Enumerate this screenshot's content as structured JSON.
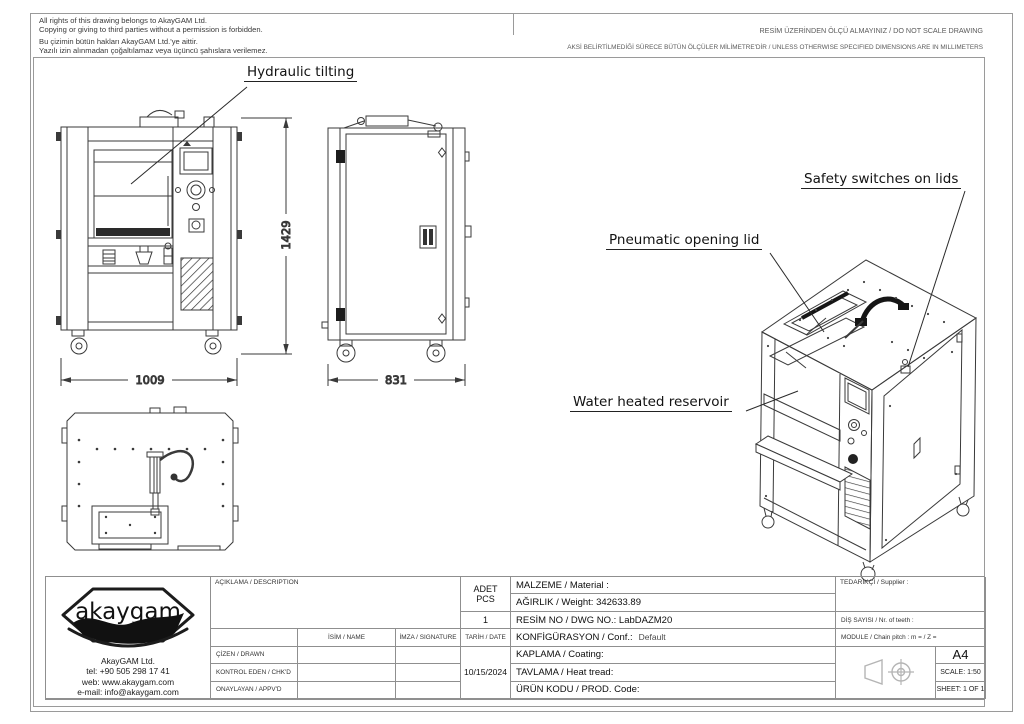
{
  "sheet": {
    "copyright": [
      "All rights of this drawing belongs to AkayGAM Ltd.",
      "Copying or giving to third parties without a permission is forbidden.",
      "Bu çizimin bütün hakları AkayGAM Ltd.'ye aittir.",
      "Yazılı izin alınmadan çoğaltılamaz veya üçüncü şahıslara verilemez."
    ],
    "note_no_scale": "RESİM ÜZERİNDEN ÖLÇÜ ALMAYINIZ / DO NOT SCALE DRAWING",
    "note_units": "AKSİ BELİRTİLMEDİĞİ SÜRECE BÜTÜN ÖLÇÜLER MİLİMETRE'DİR / UNLESS OTHERWISE SPECIFIED DIMENSIONS ARE IN MILLIMETERS"
  },
  "annotations": {
    "hydraulic_tilting": "Hydraulic tilting",
    "safety_switches": "Safety switches on lids",
    "pneumatic_lid": "Pneumatic opening lid",
    "water_reservoir": "Water heated reservoir"
  },
  "dimensions": {
    "height_mm": "1429",
    "width_mm": "1009",
    "depth_mm": "831"
  },
  "title_block": {
    "logo_text": "akaygam",
    "company": "AkayGAM Ltd.",
    "tel": "tel: +90 505 298 17 41",
    "web": "web: www.akaygam.com",
    "email": "e-mail: info@akaygam.com",
    "description_label": "AÇIKLAMA / DESCRIPTION",
    "qty_label_line1": "ADET",
    "qty_label_line2": "PCS",
    "qty_value": "1",
    "name_label": "İSİM / NAME",
    "signature_label": "İMZA / SIGNATURE",
    "date_label": "TARİH / DATE",
    "drawn_label": "ÇİZEN / DRAWN",
    "checked_label": "KONTROL EDEN / CHK'D",
    "approved_label": "ONAYLAYAN / APPV'D",
    "date_value": "10/15/2024",
    "material_label": "MALZEME / Material :",
    "weight_label": "AĞIRLIK / Weight: 342633.89",
    "dwg_label": "RESİM NO / DWG NO.: LabDAZM20",
    "config_label": "KONFİGÜRASYON / Conf.:",
    "config_value": "Default",
    "coating_label": "KAPLAMA / Coating:",
    "heat_label": "TAVLAMA / Heat tread:",
    "prod_label": "ÜRÜN KODU / PROD. Code:",
    "supplier_label": "TEDARİKÇİ / Supplier :",
    "teeth_label": "DİŞ SAYISI / Nr. of teeth :",
    "module_label": "MODULE / Chain pitch :  m =   / Z =",
    "paper_size": "A4",
    "scale": "SCALE: 1:50",
    "sheet": "SHEET: 1 OF 1"
  },
  "colors": {
    "line": "#3a3a3a",
    "grid": "#8f8f8f",
    "light": "#b5b5b5",
    "ink": "#111111"
  }
}
